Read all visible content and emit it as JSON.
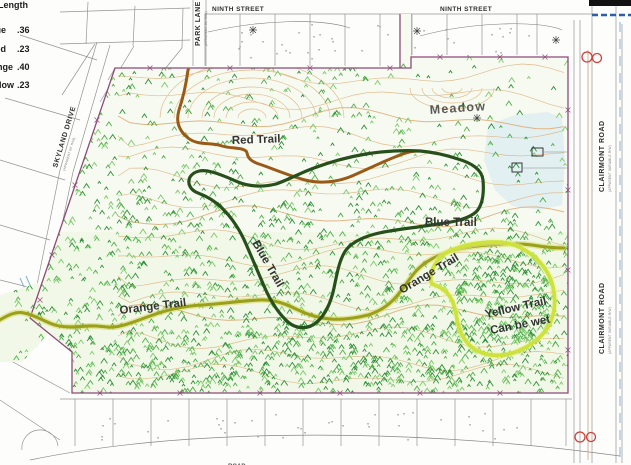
{
  "legend": {
    "header": "Length",
    "rows": [
      {
        "trail": "Blue",
        "length": ".36"
      },
      {
        "trail": "Red",
        "length": ".23"
      },
      {
        "trail": "Orange",
        "length": ".40"
      },
      {
        "trail": "Yellow",
        "length": ".23"
      }
    ]
  },
  "streets": {
    "ninth_left": "NINTH STREET",
    "ninth_right": "NINTH STREET",
    "park_lane": "PARK LANE",
    "park_lane_sub": "(APPARENT 50' R/W)",
    "skyland_drive": "SKYLAND DRIVE",
    "skyland_sub": "(APPARENT 50' R/W)",
    "clairmont_upper": "CLAIRMONT ROAD",
    "clairmont_upper_sub": "(APPARENT VARIABLE R/W)",
    "clairmont_lower": "CLAIRMONT ROAD",
    "clairmont_lower_sub": "(APPARENT VARIABLE R/W)",
    "bottom_partial": "ROAD"
  },
  "trail_labels": {
    "red": "Red Trail",
    "blue_east": "Blue Trail",
    "blue_center": "Blue Trail",
    "orange_west": "Orange Trail",
    "orange_east": "Orange Trail",
    "yellow_line1": "Yellow Trail",
    "yellow_line2": "Can be wet"
  },
  "map_text": {
    "meadow": "Meadow"
  },
  "colors": {
    "red_trail": "#995a17",
    "blue_trail": "#274f1b",
    "orange_trail": "#9aa018",
    "orange_halo": "#d6d45c",
    "yellow_trail": "#cde23a",
    "yellow_halo": "#eef59a",
    "label_red": "#b23422",
    "meadow_text": "#94a38c",
    "contour": "#d9a66a",
    "boundary": "#8d4a78",
    "lot_line": "#8f8f8f",
    "street_text": "#2e2e2e",
    "water": "#cfe6f2",
    "stream_blue": "#7fb3d6",
    "scale_bar": "#111111",
    "scale_blue": "#2d5fa8",
    "circle_red": "#d04038",
    "veg_green_1": "#4fae4a",
    "veg_green_2": "#2f8f3a",
    "veg_green_3": "#7cc96a"
  }
}
